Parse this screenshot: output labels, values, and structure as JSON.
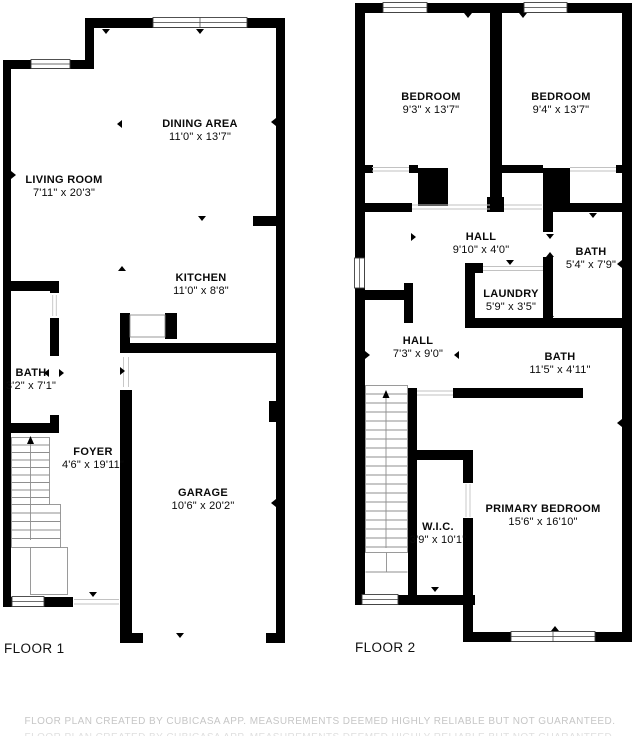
{
  "floor1": {
    "label": "FLOOR 1",
    "rooms": [
      {
        "name": "LIVING ROOM",
        "dims": "7'11\" x 20'3\""
      },
      {
        "name": "DINING AREA",
        "dims": "11'0\" x 13'7\""
      },
      {
        "name": "KITCHEN",
        "dims": "11'0\" x 8'8\""
      },
      {
        "name": "BATH",
        "dims": "3'2\" x 7'1\""
      },
      {
        "name": "FOYER",
        "dims": "4'6\" x 19'11\""
      },
      {
        "name": "GARAGE",
        "dims": "10'6\" x 20'2\""
      }
    ]
  },
  "floor2": {
    "label": "FLOOR 2",
    "rooms": [
      {
        "name": "BEDROOM",
        "dims": "9'3\" x 13'7\""
      },
      {
        "name": "BEDROOM",
        "dims": "9'4\" x 13'7\""
      },
      {
        "name": "HALL",
        "dims": "9'10\" x 4'0\""
      },
      {
        "name": "BATH",
        "dims": "5'4\" x 7'9\""
      },
      {
        "name": "LAUNDRY",
        "dims": "5'9\" x 3'5\""
      },
      {
        "name": "HALL",
        "dims": "7'3\" x 9'0\""
      },
      {
        "name": "BATH",
        "dims": "11'5\" x 4'11\""
      },
      {
        "name": "W.I.C.",
        "dims": "3'9\" x 10'1\""
      },
      {
        "name": "PRIMARY BEDROOM",
        "dims": "15'6\" x 16'10\""
      }
    ]
  },
  "footer": {
    "text": "FLOOR PLAN CREATED BY CUBICASA APP. MEASUREMENTS DEEMED HIGHLY RELIABLE BUT NOT GUARANTEED."
  },
  "colors": {
    "wall": "#000000",
    "stair_line": "#8f8f8f",
    "muted_text": "#c6c6c6"
  }
}
